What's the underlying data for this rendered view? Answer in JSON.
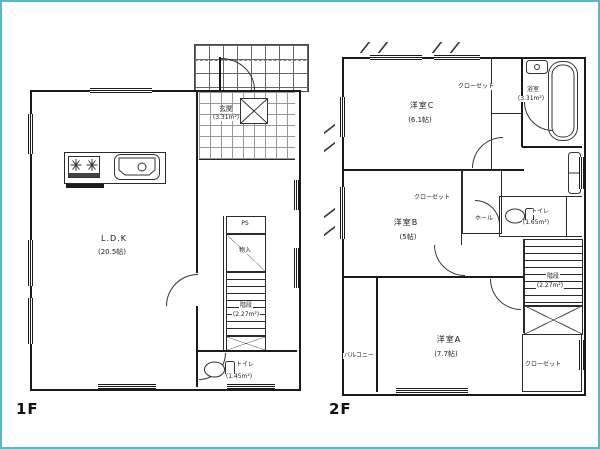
{
  "page": {
    "background": "#ffffff",
    "border_color": "#57bac3",
    "line_color": "#1b1b1b"
  },
  "floor1": {
    "label": "1F",
    "rooms": {
      "ldk": {
        "name": "L.D.K",
        "area": "(20.5帖)"
      },
      "genkan": {
        "name": "玄関",
        "area": "(3.31m²)"
      },
      "ps": {
        "name": "PS"
      },
      "monoire": {
        "name": "物入"
      },
      "stairs": {
        "name": "階段",
        "area": "(2.27m²)"
      },
      "toilet": {
        "name": "トイレ",
        "area": "(1.45m²)"
      }
    }
  },
  "floor2": {
    "label": "2F",
    "rooms": {
      "bedroomC": {
        "name": "洋室C",
        "area": "(6.1帖)"
      },
      "closet_top": {
        "name": "クローゼット"
      },
      "bath": {
        "name": "浴室",
        "area": "(3.31m²)"
      },
      "bedroomB": {
        "name": "洋室B",
        "area": "(5帖)"
      },
      "closet_mid": {
        "name": "クローゼット"
      },
      "hall": {
        "name": "ホール"
      },
      "toilet": {
        "name": "トイレ",
        "area": "(1.65m²)"
      },
      "stairs": {
        "name": "階段",
        "area": "(2.27m²)"
      },
      "bedroomA": {
        "name": "洋室A",
        "area": "(7.7帖)"
      },
      "closet_bottom": {
        "name": "クローゼット"
      },
      "balcony": {
        "name": "バルコニー"
      }
    }
  },
  "icons": {
    "stove": "stove-icon",
    "sink": "kitchen-sink-icon",
    "storage_cross": "cross-box-icon",
    "toilet": "toilet-icon",
    "bathtub": "bathtub-icon",
    "washbasin": "washbasin-icon",
    "vanity": "vanity-icon"
  }
}
